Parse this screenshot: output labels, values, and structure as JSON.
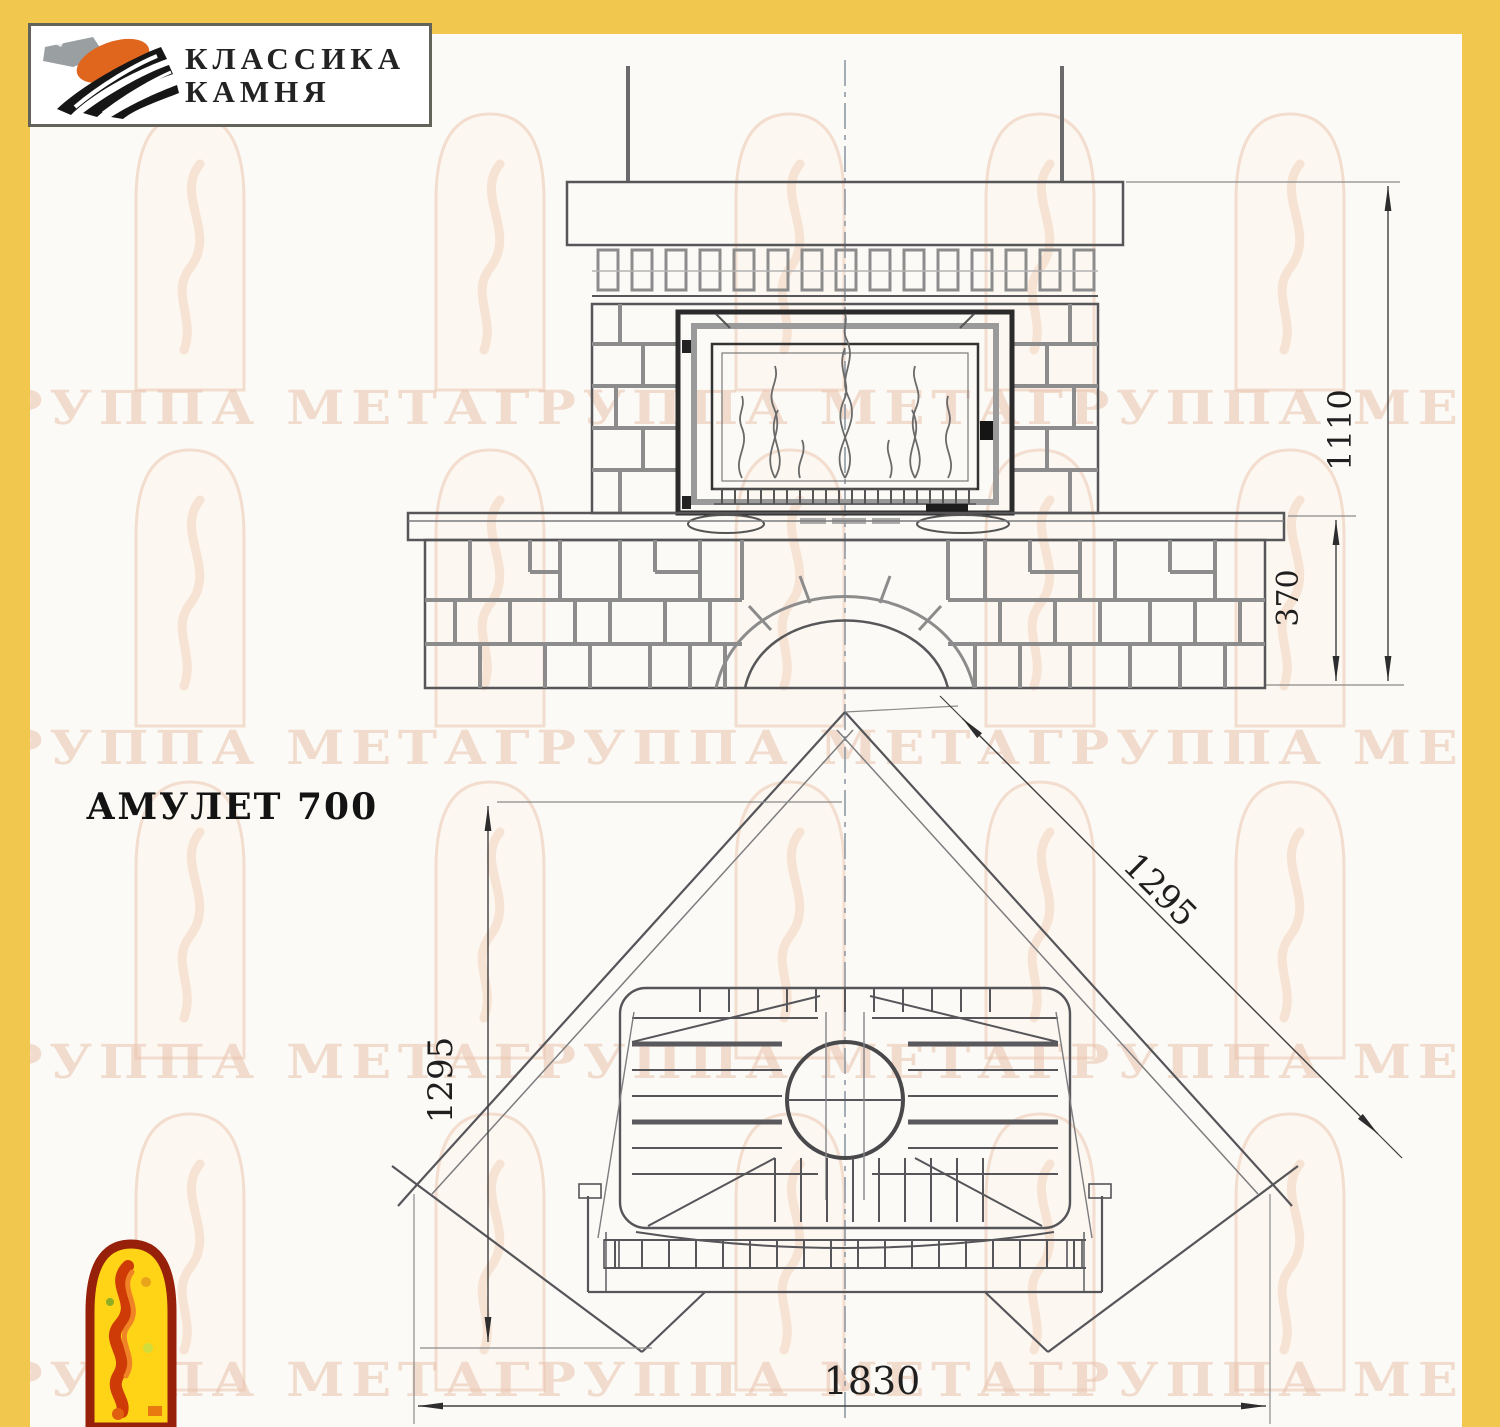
{
  "page": {
    "background": "#fbfaf6",
    "frame_color": "#f2c74e"
  },
  "brand_logo": {
    "line1": "КЛАССИКА",
    "line2": "КАМНЯ"
  },
  "model_title": "АМУЛЕТ 700",
  "watermark_text": "ГРУППА МЕТАГРУППА МЕТАГРУППА МЕТА",
  "dimensions": {
    "front_total_height": "1110",
    "front_bench_height": "370",
    "plan_left_depth": "1295",
    "plan_right_depth": "1295",
    "plan_front_width": "1830"
  },
  "colors": {
    "frame_yellow": "#f2c74e",
    "drawing_line": "#57575a",
    "mortar_gray": "#8c8c8c",
    "dim_line": "#3f3f3f",
    "watermark_tint": "#e9c3ad",
    "logo_orange": "#e0651d",
    "logo_stone_gray": "#9aa0a2",
    "logo_black": "#161616",
    "emblem_border_red": "#96200a",
    "emblem_yellow": "#ffd416",
    "emblem_flame_red": "#cf3b06",
    "emblem_flame_orange": "#f08326"
  }
}
